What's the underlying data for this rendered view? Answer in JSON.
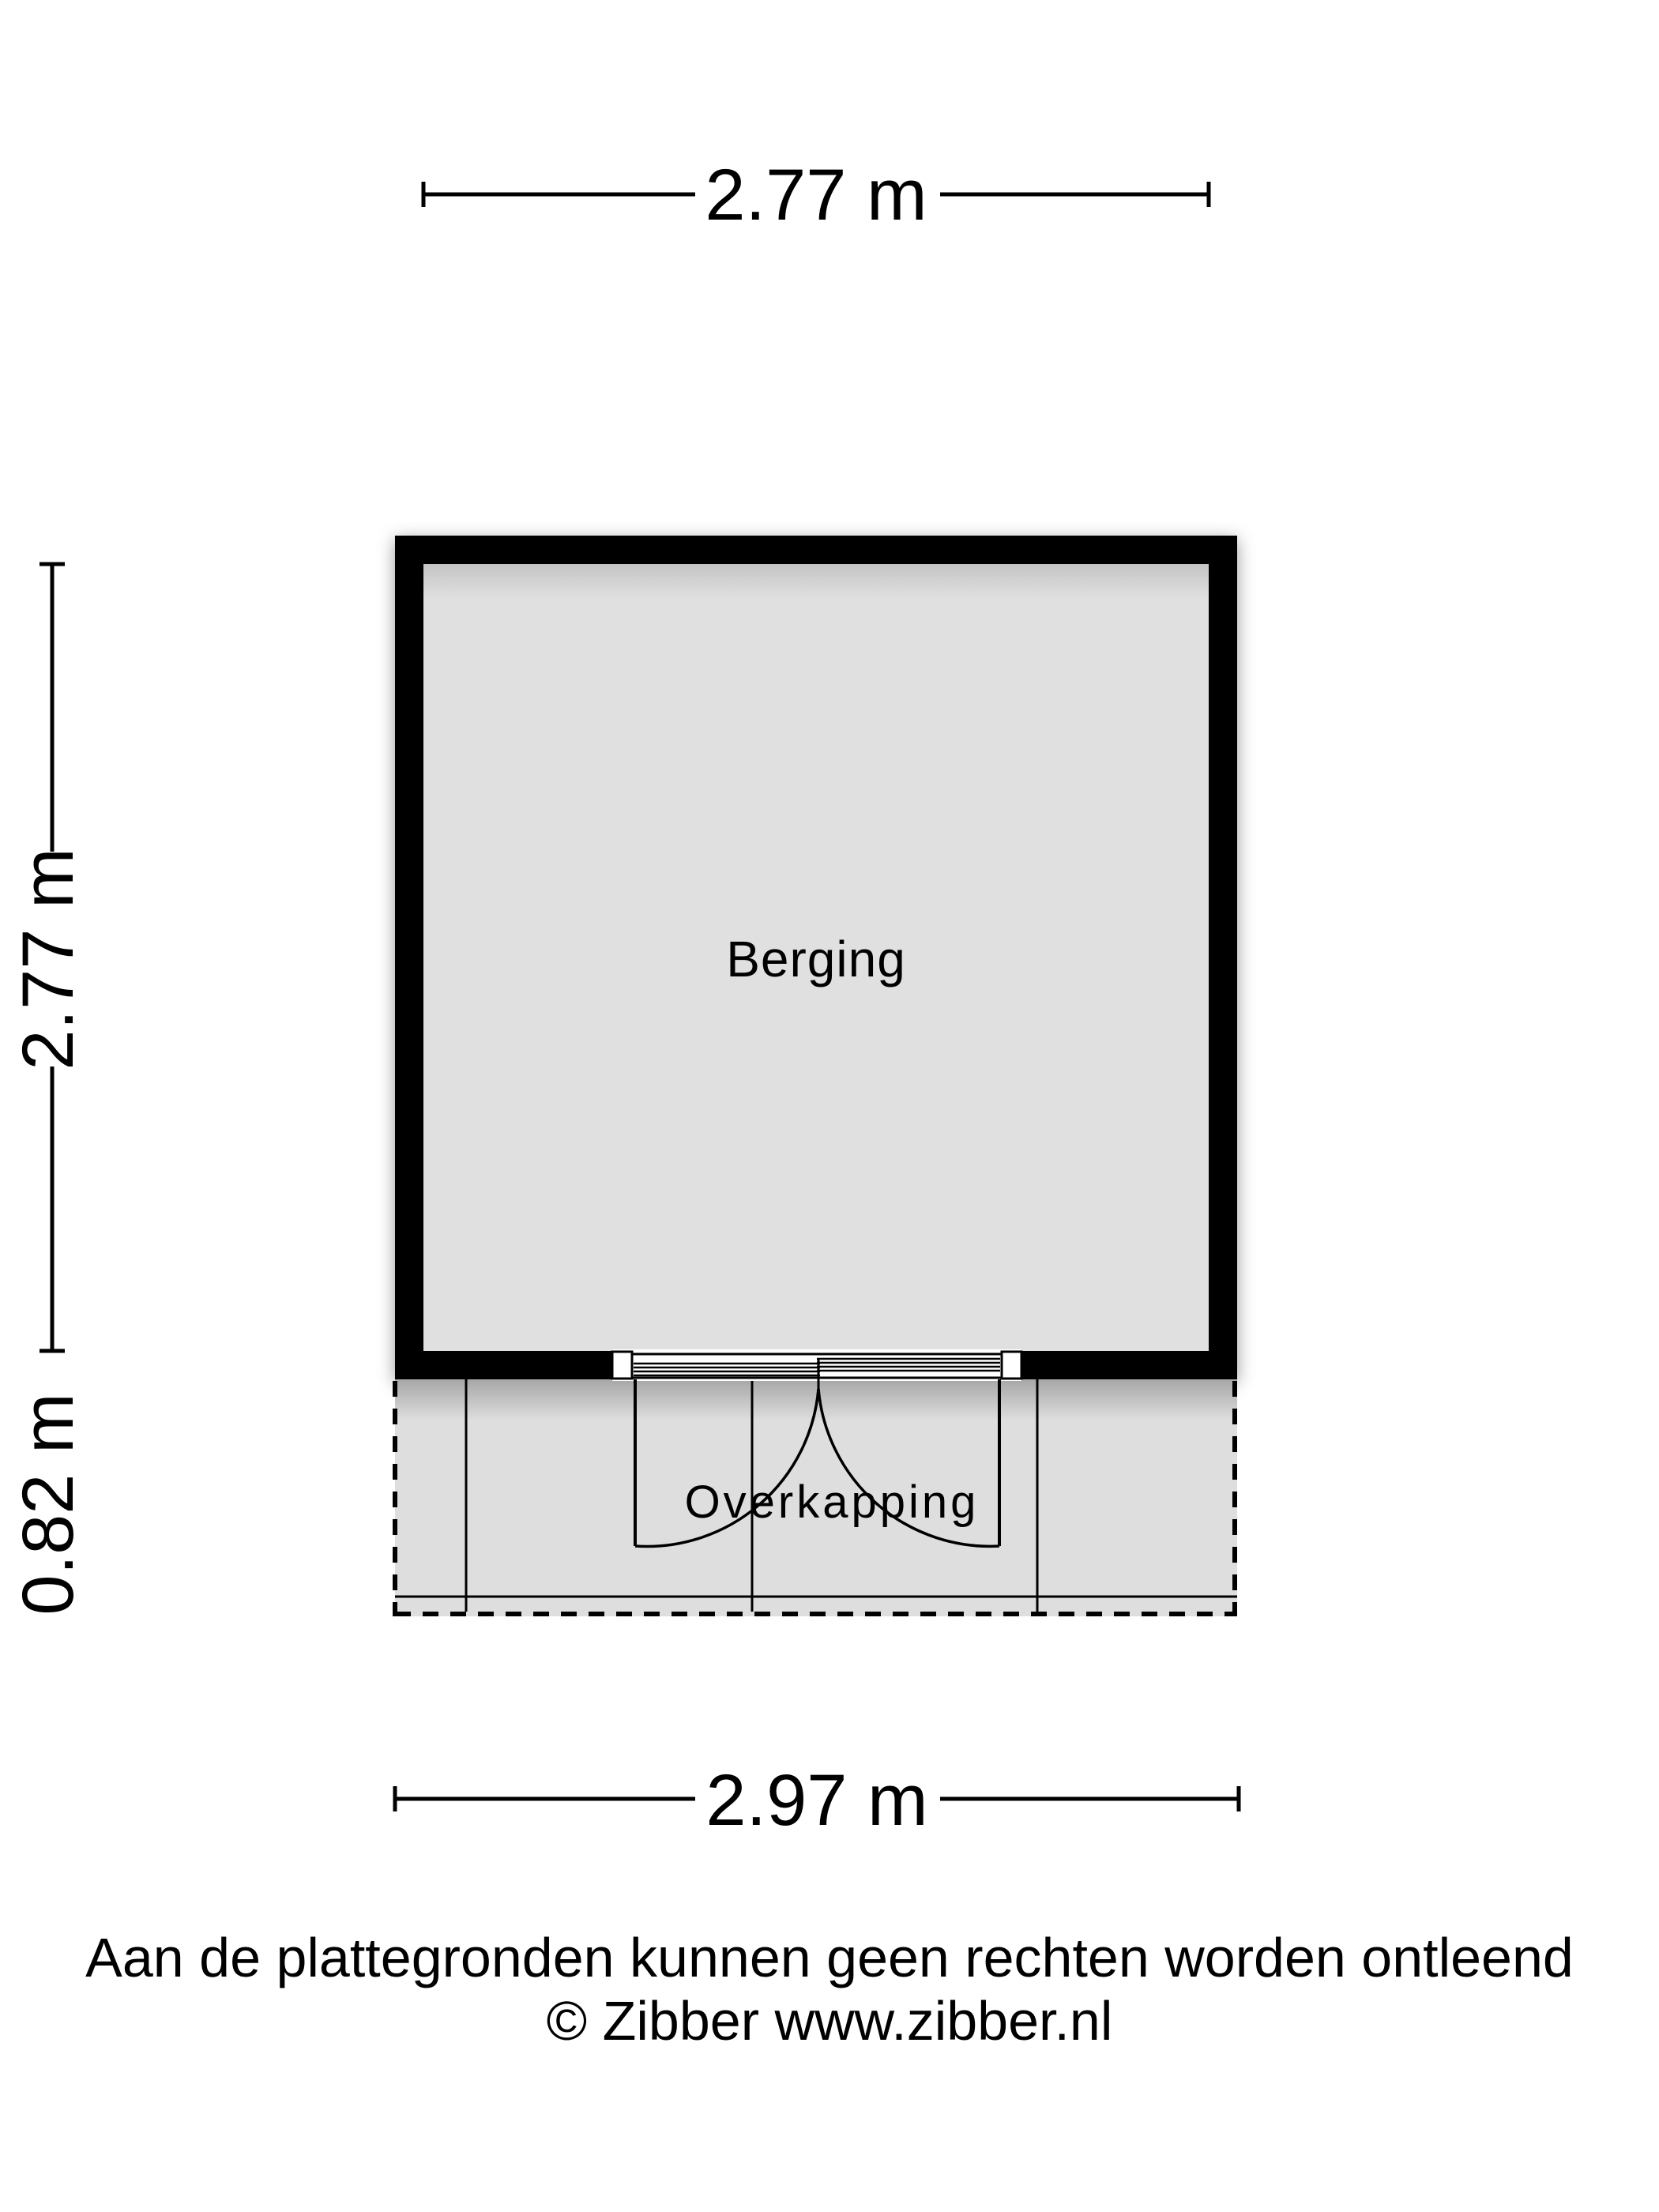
{
  "plan": {
    "room_label": "Berging",
    "canopy_label": "Overkapping",
    "colors": {
      "wall": "#000000",
      "room_fill": "#e0e0e0",
      "canopy_fill": "#dedede",
      "background": "#ffffff",
      "linework": "#000000"
    }
  },
  "dimensions": {
    "top_width": "2.77 m",
    "left_height": "2.77 m",
    "left_canopy_depth": "0.82 m",
    "bottom_width": "2.97 m"
  },
  "footer": {
    "disclaimer": "Aan de plattegronden kunnen geen rechten worden ontleend",
    "credit": "© Zibber www.zibber.nl"
  }
}
